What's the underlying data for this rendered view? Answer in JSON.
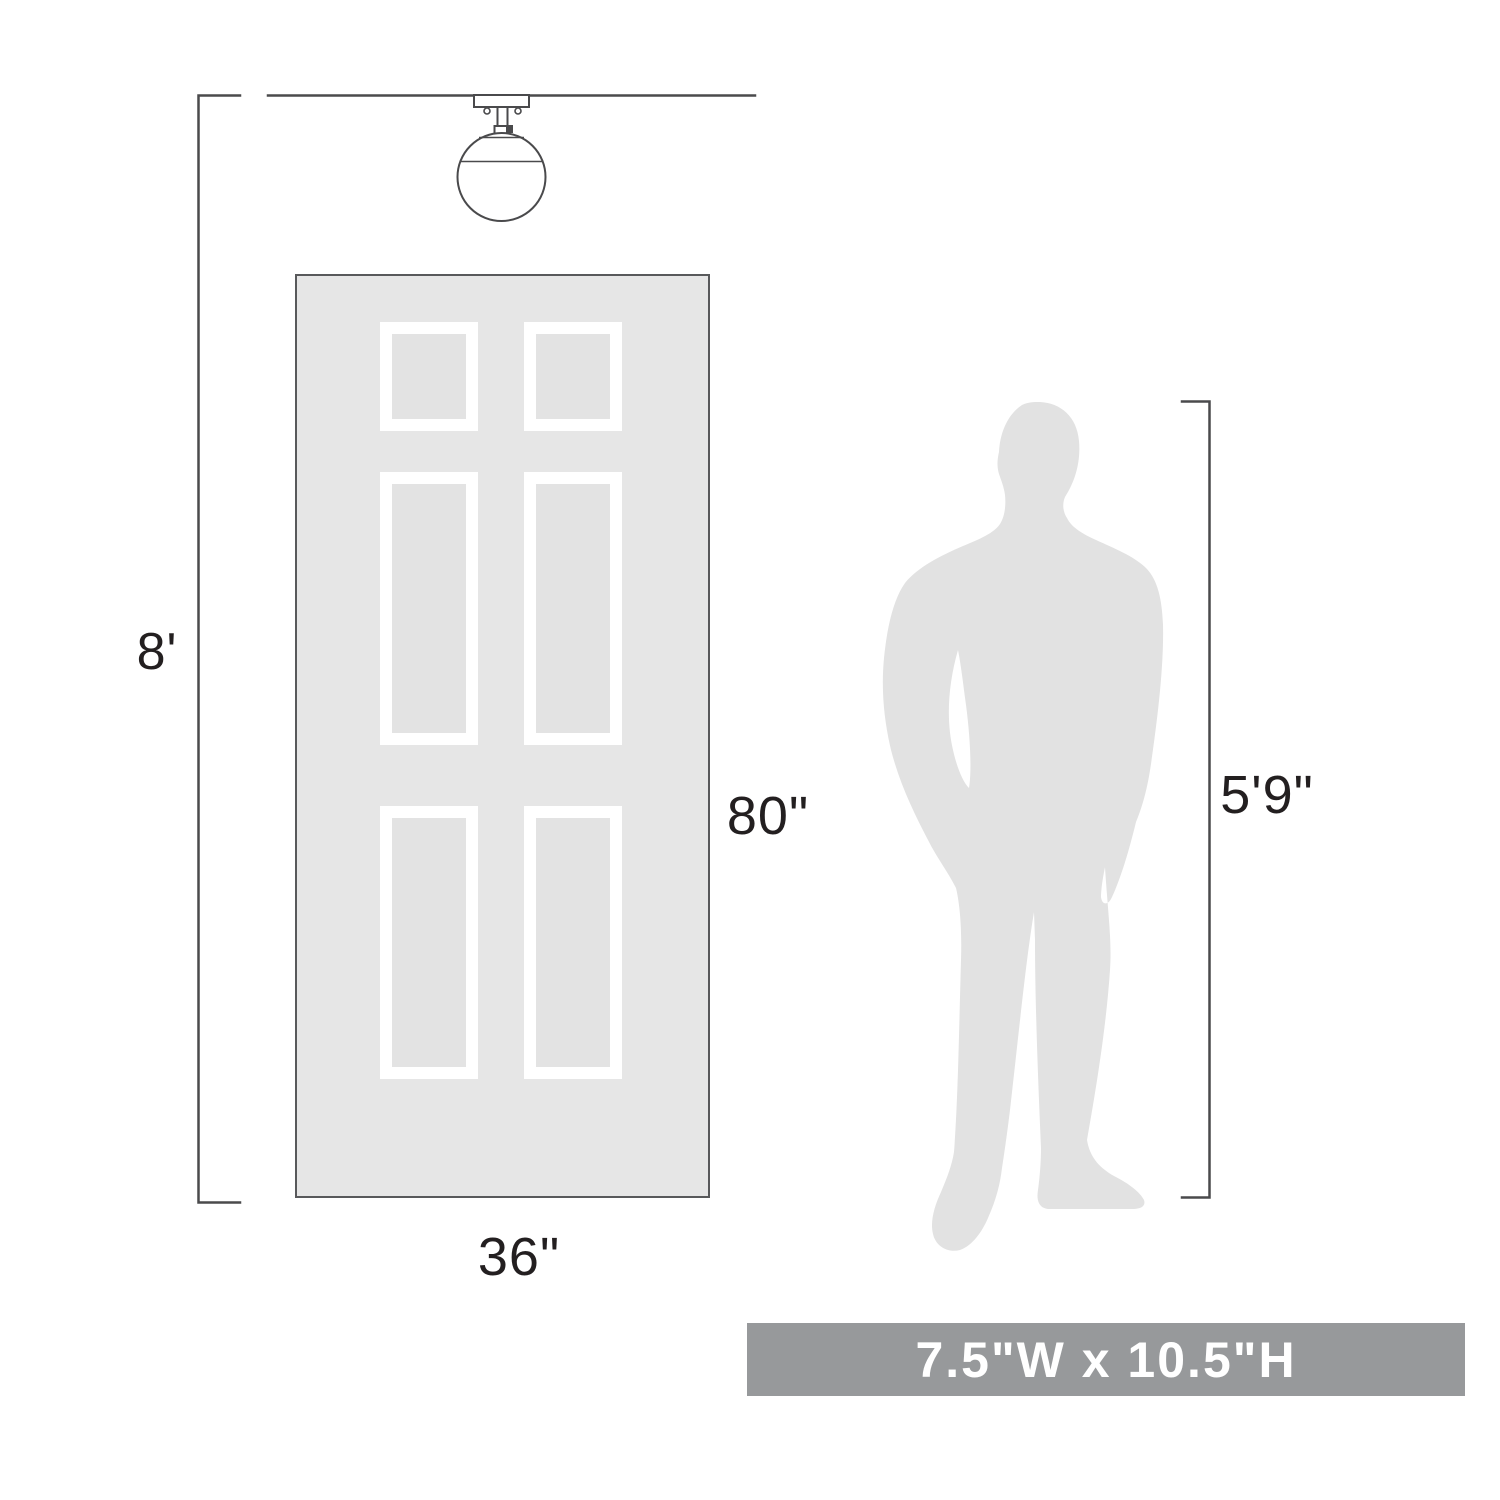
{
  "labels": {
    "ceiling_height": "8'",
    "door_height": "80\"",
    "door_width": "36\"",
    "person_height": "5'9\""
  },
  "banner": {
    "size_text": "7.5\"W x 10.5\"H"
  },
  "colors": {
    "background": "#ffffff",
    "line": "#4a4a4c",
    "label_text": "#231f20",
    "door_fill": "#e6e6e6",
    "door_border": "#58595b",
    "panel_inner": "#e3e3e3",
    "panel_frame": "#ffffff",
    "silhouette": "#e2e2e2",
    "banner_bg": "#97999b",
    "banner_text": "#ffffff"
  }
}
